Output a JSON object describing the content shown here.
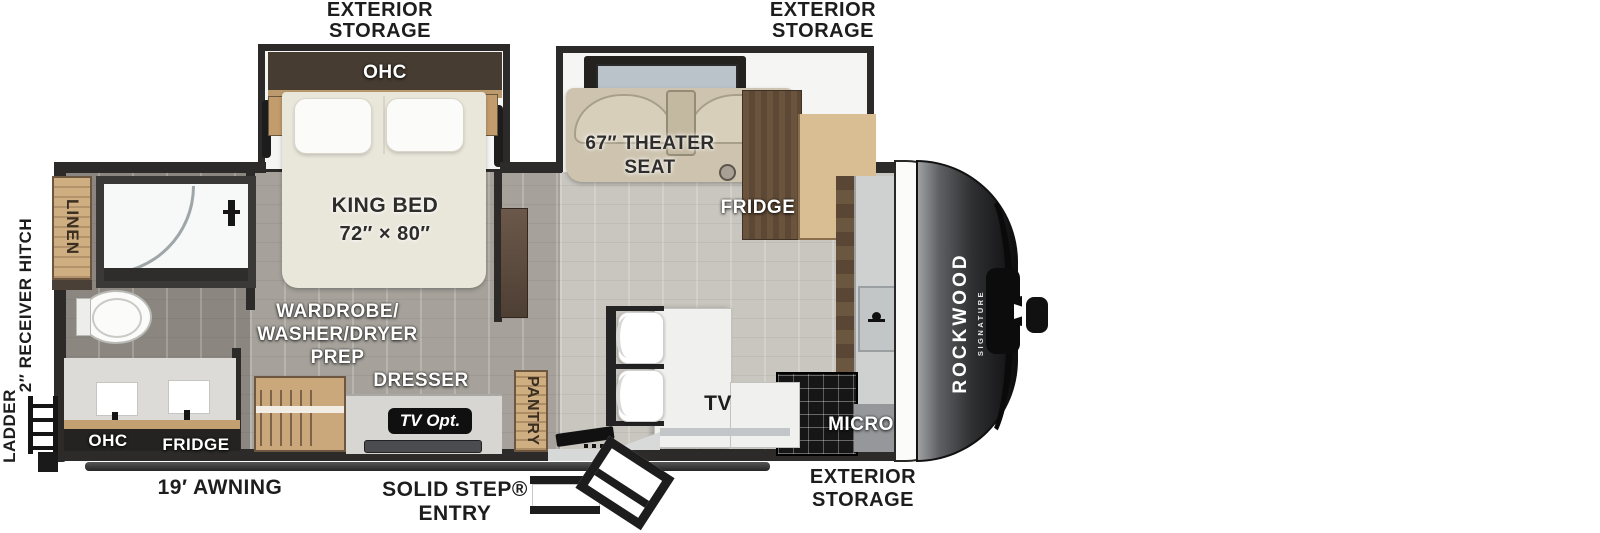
{
  "title": "Rockwood Signature travel trailer floor plan",
  "brand": {
    "name": "ROCKWOOD",
    "sub": "SIGNATURE"
  },
  "exterior": {
    "storage_top_left": {
      "line1": "EXTERIOR",
      "line2": "STORAGE"
    },
    "storage_top_right": {
      "line1": "EXTERIOR",
      "line2": "STORAGE"
    },
    "storage_bottom_right": {
      "line1": "EXTERIOR",
      "line2": "STORAGE"
    },
    "awning": "19′ AWNING",
    "entry": {
      "line1": "SOLID STEP®",
      "line2": "ENTRY"
    },
    "receiver_hitch": "2″ RECEIVER HITCH",
    "ladder": "LADDER"
  },
  "bedroom": {
    "ohc": "OHC",
    "bed_line1": "KING BED",
    "bed_line2": "72″ × 80″",
    "wardrobe_line1": "WARDROBE/",
    "wardrobe_line2": "WASHER/DRYER",
    "wardrobe_line3": "PREP",
    "dresser": "DRESSER",
    "tv_opt": "TV Opt."
  },
  "bathroom": {
    "linen": "LINEN",
    "ohc": "OHC",
    "fridge": "FRIDGE"
  },
  "living": {
    "theater_line1": "67″ THEATER",
    "theater_line2": "SEAT",
    "fridge": "FRIDGE",
    "pantry": "PANTRY",
    "tv": "TV",
    "micro": "MICRO",
    "kitchen_ohc": "OHC"
  },
  "colors": {
    "wall": "#2d2b29",
    "floor_main": "#c9c6bf",
    "floor_bedroom": "#a6a29b",
    "floor_bathroom": "#8b8780",
    "wood_light": "#cfae82",
    "wood_dark": "#5d4835",
    "bed_cream": "#e9e6da",
    "sofa_beige": "#cdc3ae",
    "front_cap_dark": "#141415"
  }
}
